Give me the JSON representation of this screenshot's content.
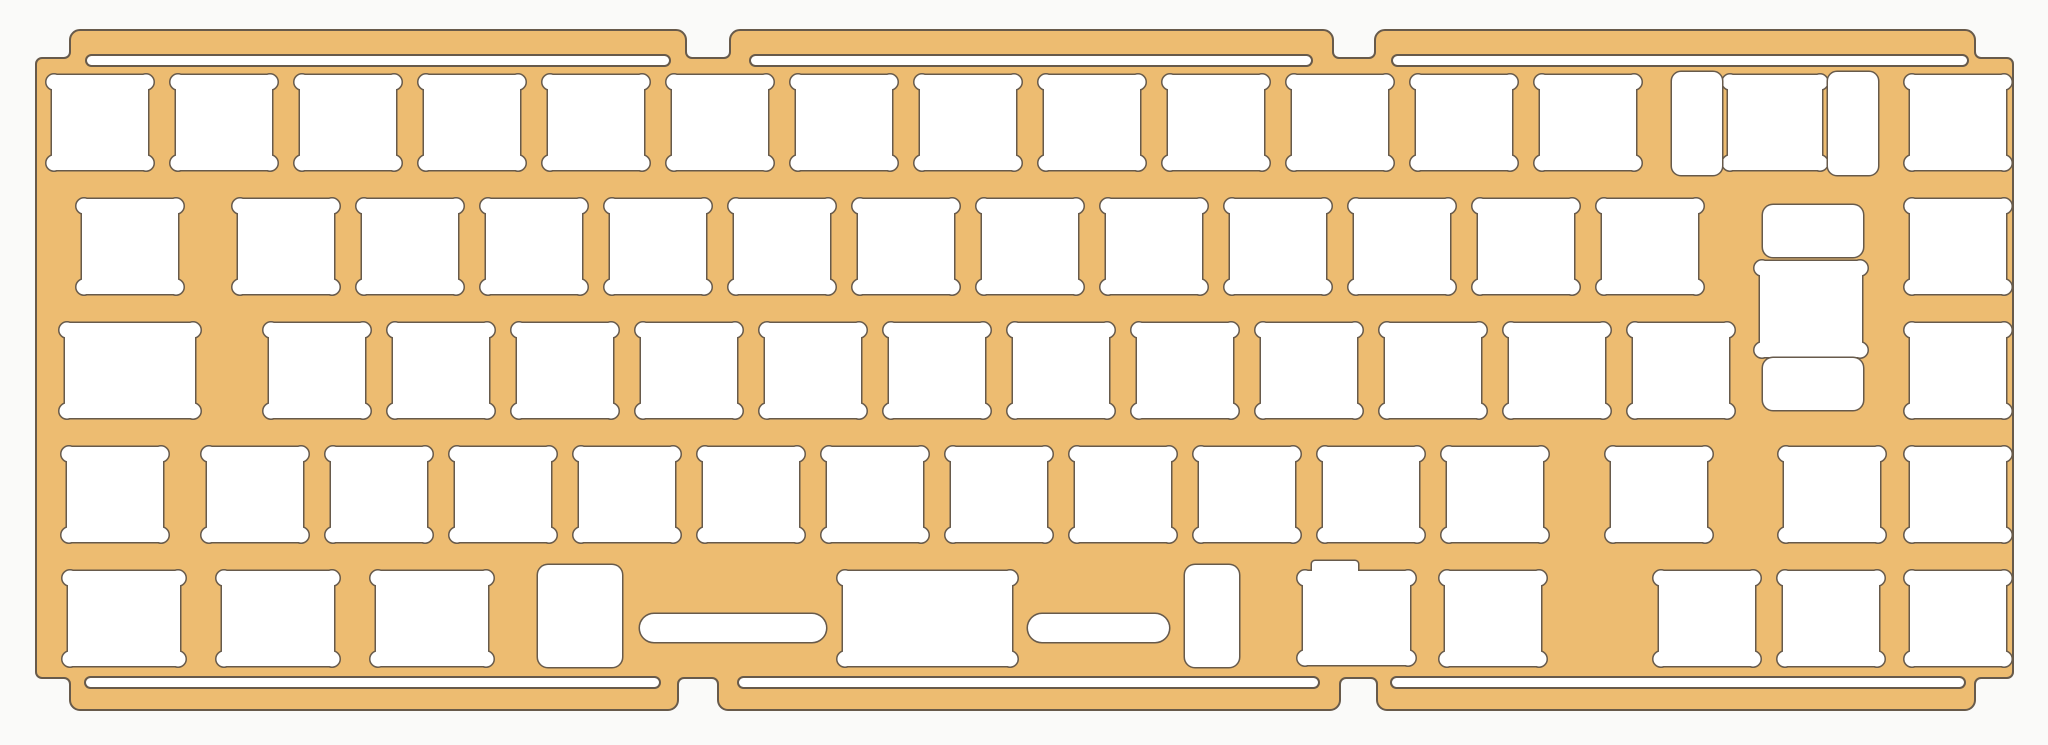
{
  "canvas": {
    "width": 2048,
    "height": 745
  },
  "colors": {
    "background": "#fafaf9",
    "plate": "#edbc71",
    "outline": "#675a4b",
    "cutout": "#ffffff"
  },
  "notch_style": {
    "corner_radius": 5,
    "ear_radius": 7.5,
    "ear_inset_x": 2,
    "ear_inset_y": 7
  },
  "plate_outline_path": "M 36 670 L 36 64 A 6 6 0 0 1 42 58 L 64 58 A 6 6 0 0 0 70 52 L 70 40 A 10 10 0 0 1 80 30 L 676 30 A 10 10 0 0 1 686 40 L 686 52 A 6 6 0 0 0 692 58 L 724 58 A 6 6 0 0 0 730 52 L 730 40 A 10 10 0 0 1 740 30 L 1323 30 A 10 10 0 0 1 1333 40 L 1333 52 A 6 6 0 0 0 1339 58 L 1369 58 A 6 6 0 0 0 1375 52 L 1375 40 A 10 10 0 0 1 1385 30 L 1965 30 A 10 10 0 0 1 1975 40 L 1975 52 A 6 6 0 0 0 1981 58 L 2007 58 A 6 6 0 0 1 2013 64 L 2013 672 A 6 6 0 0 1 2007 678 L 1981 678 A 6 6 0 0 0 1975 684 L 1975 700 A 10 10 0 0 1 1965 710 L 1387 710 A 10 10 0 0 1 1377 700 L 1377 684 A 6 6 0 0 0 1371 678 L 1346 678 A 6 6 0 0 0 1340 684 L 1340 700 A 10 10 0 0 1 1330 710 L 728 710 A 10 10 0 0 1 718 700 L 718 684 A 6 6 0 0 0 712 678 L 684 678 A 6 6 0 0 0 678 684 L 678 700 A 10 10 0 0 1 668 710 L 80 710 A 10 10 0 0 1 70 700 L 70 684 A 6 6 0 0 0 64 678 L 42 678 A 6 6 0 0 1 36 672 Z",
  "edge_slots": [
    {
      "name": "top-edge-slot-left",
      "x": 86,
      "y": 55,
      "w": 584,
      "h": 11
    },
    {
      "name": "top-edge-slot-middle",
      "x": 750,
      "y": 55,
      "w": 562,
      "h": 11
    },
    {
      "name": "top-edge-slot-right",
      "x": 1392,
      "y": 55,
      "w": 576,
      "h": 11
    },
    {
      "name": "bottom-edge-slot-left",
      "x": 85,
      "y": 677,
      "w": 575,
      "h": 11
    },
    {
      "name": "bottom-edge-slot-middle",
      "x": 738,
      "y": 677,
      "w": 581,
      "h": 11
    },
    {
      "name": "bottom-edge-slot-right",
      "x": 1391,
      "y": 677,
      "w": 574,
      "h": 11
    }
  ],
  "switch_cutouts": [
    {
      "row": "number-row",
      "x": 52,
      "y": 75,
      "w": 96,
      "h": 95
    },
    {
      "row": "number-row",
      "x": 176,
      "y": 75,
      "w": 96,
      "h": 95
    },
    {
      "row": "number-row",
      "x": 300,
      "y": 75,
      "w": 96,
      "h": 95
    },
    {
      "row": "number-row",
      "x": 424,
      "y": 75,
      "w": 96,
      "h": 95
    },
    {
      "row": "number-row",
      "x": 548,
      "y": 75,
      "w": 96,
      "h": 95
    },
    {
      "row": "number-row",
      "x": 672,
      "y": 75,
      "w": 96,
      "h": 95
    },
    {
      "row": "number-row",
      "x": 796,
      "y": 75,
      "w": 96,
      "h": 95
    },
    {
      "row": "number-row",
      "x": 920,
      "y": 75,
      "w": 96,
      "h": 95
    },
    {
      "row": "number-row",
      "x": 1044,
      "y": 75,
      "w": 96,
      "h": 95
    },
    {
      "row": "number-row",
      "x": 1168,
      "y": 75,
      "w": 96,
      "h": 95
    },
    {
      "row": "number-row",
      "x": 1292,
      "y": 75,
      "w": 96,
      "h": 95
    },
    {
      "row": "number-row",
      "x": 1416,
      "y": 75,
      "w": 96,
      "h": 95
    },
    {
      "row": "number-row",
      "x": 1540,
      "y": 75,
      "w": 96,
      "h": 95
    },
    {
      "row": "number-row-backspace",
      "x": 1728,
      "y": 75,
      "w": 94,
      "h": 95
    },
    {
      "row": "number-row",
      "x": 1910,
      "y": 75,
      "w": 96,
      "h": 95
    },
    {
      "row": "tab-row",
      "x": 82,
      "y": 199,
      "w": 96,
      "h": 95
    },
    {
      "row": "tab-row",
      "x": 238,
      "y": 199,
      "w": 96,
      "h": 95
    },
    {
      "row": "tab-row",
      "x": 362,
      "y": 199,
      "w": 96,
      "h": 95
    },
    {
      "row": "tab-row",
      "x": 486,
      "y": 199,
      "w": 96,
      "h": 95
    },
    {
      "row": "tab-row",
      "x": 610,
      "y": 199,
      "w": 96,
      "h": 95
    },
    {
      "row": "tab-row",
      "x": 734,
      "y": 199,
      "w": 96,
      "h": 95
    },
    {
      "row": "tab-row",
      "x": 858,
      "y": 199,
      "w": 96,
      "h": 95
    },
    {
      "row": "tab-row",
      "x": 982,
      "y": 199,
      "w": 96,
      "h": 95
    },
    {
      "row": "tab-row",
      "x": 1106,
      "y": 199,
      "w": 96,
      "h": 95
    },
    {
      "row": "tab-row",
      "x": 1230,
      "y": 199,
      "w": 96,
      "h": 95
    },
    {
      "row": "tab-row",
      "x": 1354,
      "y": 199,
      "w": 96,
      "h": 95
    },
    {
      "row": "tab-row",
      "x": 1478,
      "y": 199,
      "w": 96,
      "h": 95
    },
    {
      "row": "tab-row",
      "x": 1602,
      "y": 199,
      "w": 96,
      "h": 95
    },
    {
      "row": "iso-enter",
      "x": 1760,
      "y": 261,
      "w": 102,
      "h": 96
    },
    {
      "row": "tab-row",
      "x": 1910,
      "y": 199,
      "w": 96,
      "h": 95
    },
    {
      "row": "caps-row-capslock",
      "x": 65,
      "y": 323,
      "w": 130,
      "h": 95
    },
    {
      "row": "caps-row",
      "x": 269,
      "y": 323,
      "w": 96,
      "h": 95
    },
    {
      "row": "caps-row",
      "x": 393,
      "y": 323,
      "w": 96,
      "h": 95
    },
    {
      "row": "caps-row",
      "x": 517,
      "y": 323,
      "w": 96,
      "h": 95
    },
    {
      "row": "caps-row",
      "x": 641,
      "y": 323,
      "w": 96,
      "h": 95
    },
    {
      "row": "caps-row",
      "x": 765,
      "y": 323,
      "w": 96,
      "h": 95
    },
    {
      "row": "caps-row",
      "x": 889,
      "y": 323,
      "w": 96,
      "h": 95
    },
    {
      "row": "caps-row",
      "x": 1013,
      "y": 323,
      "w": 96,
      "h": 95
    },
    {
      "row": "caps-row",
      "x": 1137,
      "y": 323,
      "w": 96,
      "h": 95
    },
    {
      "row": "caps-row",
      "x": 1261,
      "y": 323,
      "w": 96,
      "h": 95
    },
    {
      "row": "caps-row",
      "x": 1385,
      "y": 323,
      "w": 96,
      "h": 95
    },
    {
      "row": "caps-row",
      "x": 1509,
      "y": 323,
      "w": 96,
      "h": 95
    },
    {
      "row": "caps-row",
      "x": 1633,
      "y": 323,
      "w": 96,
      "h": 95
    },
    {
      "row": "caps-row",
      "x": 1910,
      "y": 323,
      "w": 96,
      "h": 95
    },
    {
      "row": "shift-row-lshift",
      "x": 67,
      "y": 447,
      "w": 96,
      "h": 95
    },
    {
      "row": "shift-row",
      "x": 207,
      "y": 447,
      "w": 96,
      "h": 95
    },
    {
      "row": "shift-row",
      "x": 331,
      "y": 447,
      "w": 96,
      "h": 95
    },
    {
      "row": "shift-row",
      "x": 455,
      "y": 447,
      "w": 96,
      "h": 95
    },
    {
      "row": "shift-row",
      "x": 579,
      "y": 447,
      "w": 96,
      "h": 95
    },
    {
      "row": "shift-row",
      "x": 703,
      "y": 447,
      "w": 96,
      "h": 95
    },
    {
      "row": "shift-row",
      "x": 827,
      "y": 447,
      "w": 96,
      "h": 95
    },
    {
      "row": "shift-row",
      "x": 951,
      "y": 447,
      "w": 96,
      "h": 95
    },
    {
      "row": "shift-row",
      "x": 1075,
      "y": 447,
      "w": 96,
      "h": 95
    },
    {
      "row": "shift-row",
      "x": 1199,
      "y": 447,
      "w": 96,
      "h": 95
    },
    {
      "row": "shift-row",
      "x": 1323,
      "y": 447,
      "w": 96,
      "h": 95
    },
    {
      "row": "shift-row",
      "x": 1447,
      "y": 447,
      "w": 96,
      "h": 95
    },
    {
      "row": "shift-row-rshift",
      "x": 1611,
      "y": 447,
      "w": 96,
      "h": 95
    },
    {
      "row": "shift-row",
      "x": 1784,
      "y": 447,
      "w": 96,
      "h": 95
    },
    {
      "row": "shift-row",
      "x": 1910,
      "y": 447,
      "w": 96,
      "h": 95
    },
    {
      "row": "bottom-row-mod",
      "x": 68,
      "y": 571,
      "w": 112,
      "h": 95
    },
    {
      "row": "bottom-row-mod",
      "x": 222,
      "y": 571,
      "w": 112,
      "h": 95
    },
    {
      "row": "bottom-row-mod",
      "x": 376,
      "y": 571,
      "w": 112,
      "h": 95
    },
    {
      "row": "bottom-row-spacebar",
      "x": 843,
      "y": 571,
      "w": 169,
      "h": 95
    },
    {
      "row": "bottom-row-mod",
      "x": 1445,
      "y": 571,
      "w": 96,
      "h": 95
    },
    {
      "row": "bottom-row-arrow",
      "x": 1659,
      "y": 571,
      "w": 96,
      "h": 95
    },
    {
      "row": "bottom-row-arrow",
      "x": 1783,
      "y": 571,
      "w": 96,
      "h": 95
    },
    {
      "row": "bottom-row-arrow",
      "x": 1910,
      "y": 571,
      "w": 96,
      "h": 95
    }
  ],
  "plain_cutouts": [
    {
      "name": "backspace-stab-left",
      "x": 1672,
      "y": 72,
      "w": 50,
      "h": 103,
      "r": 9
    },
    {
      "name": "backspace-stab-right",
      "x": 1828,
      "y": 72,
      "w": 50,
      "h": 103,
      "r": 9
    },
    {
      "name": "iso-enter-stab-top",
      "x": 1763,
      "y": 205,
      "w": 100,
      "h": 52,
      "r": 10
    },
    {
      "name": "iso-enter-stab-bottom",
      "x": 1763,
      "y": 358,
      "w": 100,
      "h": 52,
      "r": 10
    },
    {
      "name": "spacebar-stab-left",
      "x": 538,
      "y": 565,
      "w": 84,
      "h": 102,
      "r": 10
    },
    {
      "name": "spacebar-stab-right",
      "x": 1185,
      "y": 565,
      "w": 54,
      "h": 102,
      "r": 10
    },
    {
      "name": "spacebar-slot-left",
      "x": 640,
      "y": 614,
      "w": 186,
      "h": 28,
      "r": 14
    },
    {
      "name": "spacebar-slot-right",
      "x": 1028,
      "y": 614,
      "w": 141,
      "h": 28,
      "r": 14
    }
  ],
  "lipped_cutouts": [
    {
      "name": "bottom-row-mod-stepped",
      "x": 1303,
      "y": 571,
      "w": 107,
      "h": 94,
      "lip_x": 1312,
      "lip_y": 561,
      "lip_w": 46,
      "lip_h": 14
    }
  ]
}
